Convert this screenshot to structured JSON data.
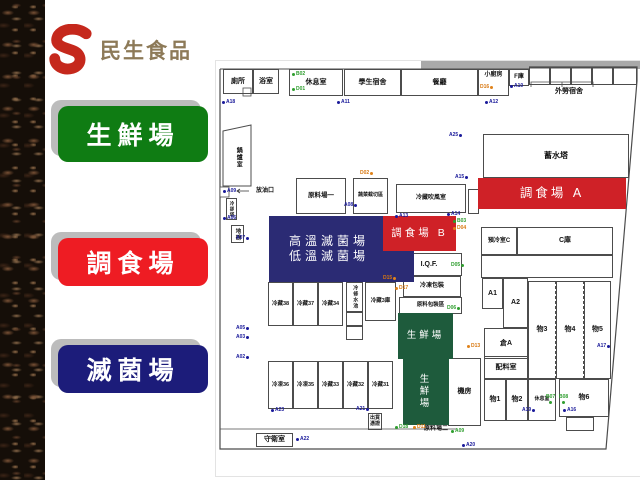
{
  "logo": {
    "brand": "民生食品",
    "accent_color": "#c5281c",
    "text_color": "#8d7a58"
  },
  "legend": [
    {
      "id": "fresh-area",
      "label": "生鮮場",
      "color": "#0f7c13",
      "y": 106,
      "h": 56
    },
    {
      "id": "prepared-food-area",
      "label": "調食場",
      "color": "#ee1c23",
      "y": 238,
      "h": 48
    },
    {
      "id": "sterilization-area",
      "label": "滅菌場",
      "color": "#1c1c7a",
      "y": 345,
      "h": 48
    }
  ],
  "map": {
    "zones": [
      {
        "lines": [
          "高溫滅菌場",
          "低溫滅菌場"
        ],
        "color": "#2b2b74",
        "x": 53,
        "y": 155,
        "w": 145,
        "h": 66,
        "fs": 12,
        "alignL": true
      },
      {
        "lines": [
          "調食場 B"
        ],
        "color": "#cf2127",
        "x": 167,
        "y": 155,
        "w": 73,
        "h": 35,
        "fs": 10.5
      },
      {
        "lines": [
          "調食場 A"
        ],
        "color": "#cf2127",
        "x": 262,
        "y": 117,
        "w": 148,
        "h": 31,
        "fs": 12.5
      },
      {
        "lines": [
          "生鮮場"
        ],
        "color": "#1e5b3c",
        "x": 182,
        "y": 252,
        "w": 55,
        "h": 46,
        "fs": 9.5
      },
      {
        "lines": [
          "生",
          "鮮",
          "場"
        ],
        "color": "#1e5b3c",
        "x": 187,
        "y": 298,
        "w": 46,
        "h": 66,
        "fs": 9.5
      }
    ],
    "rooms": [
      {
        "t": "廁所",
        "x": 7,
        "y": 8,
        "w": 30,
        "h": 25,
        "fs": 7
      },
      {
        "t": "浴室",
        "x": 37,
        "y": 8,
        "w": 26,
        "h": 25,
        "fs": 7
      },
      {
        "t": "休息室",
        "x": 73,
        "y": 8,
        "w": 54,
        "h": 27,
        "fs": 7
      },
      {
        "t": "學生宿舍",
        "x": 128,
        "y": 8,
        "w": 57,
        "h": 27,
        "fs": 7
      },
      {
        "t": "餐廳",
        "x": 185,
        "y": 8,
        "w": 77,
        "h": 27,
        "fs": 7
      },
      {
        "t": "小廚房",
        "x": 262,
        "y": 8,
        "w": 31,
        "h": 27,
        "fs": 6,
        "top": true
      },
      {
        "t": "F庫",
        "x": 293,
        "y": 8,
        "w": 20,
        "h": 17,
        "fs": 6
      },
      {
        "t": "",
        "x": 313,
        "y": 6,
        "w": 21,
        "h": 18
      },
      {
        "t": "",
        "x": 334,
        "y": 6,
        "w": 21,
        "h": 18
      },
      {
        "t": "",
        "x": 355,
        "y": 6,
        "w": 21,
        "h": 18
      },
      {
        "t": "",
        "x": 376,
        "y": 6,
        "w": 21,
        "h": 18
      },
      {
        "t": "",
        "x": 397,
        "y": 6,
        "w": 24,
        "h": 18
      },
      {
        "t": "外勞宿舍",
        "x": 323,
        "y": 25,
        "w": 60,
        "h": 11,
        "fs": 7,
        "plain": true
      },
      {
        "t": "蓄水塔",
        "x": 267,
        "y": 73,
        "w": 146,
        "h": 44,
        "fs": 8
      },
      {
        "t": "預冷室C",
        "x": 265,
        "y": 166,
        "w": 36,
        "h": 28,
        "fs": 6
      },
      {
        "t": "C庫",
        "x": 301,
        "y": 166,
        "w": 96,
        "h": 28,
        "fs": 7
      },
      {
        "t": "",
        "x": 265,
        "y": 194,
        "w": 132,
        "h": 23
      },
      {
        "t": "A1",
        "x": 266,
        "y": 217,
        "w": 21,
        "h": 31,
        "fs": 7
      },
      {
        "t": "A2",
        "x": 287,
        "y": 217,
        "w": 25,
        "h": 50,
        "fs": 7
      },
      {
        "t": "倉A",
        "x": 268,
        "y": 267,
        "w": 44,
        "h": 31,
        "fs": 7
      },
      {
        "t": "物3",
        "x": 312,
        "y": 220,
        "w": 28,
        "h": 98,
        "fs": 7,
        "dashR": true
      },
      {
        "t": "物4",
        "x": 340,
        "y": 220,
        "w": 28,
        "h": 98,
        "fs": 7,
        "dashR": true
      },
      {
        "t": "物5",
        "x": 368,
        "y": 220,
        "w": 27,
        "h": 98,
        "fs": 7
      },
      {
        "t": "配料室",
        "x": 268,
        "y": 295,
        "w": 44,
        "h": 23,
        "fs": 7
      },
      {
        "t": "物1",
        "x": 268,
        "y": 318,
        "w": 22,
        "h": 42,
        "fs": 7
      },
      {
        "t": "物2",
        "x": 290,
        "y": 318,
        "w": 22,
        "h": 42,
        "fs": 7
      },
      {
        "t": "休息室",
        "x": 312,
        "y": 318,
        "w": 28,
        "h": 42,
        "fs": 5
      },
      {
        "t": "物6",
        "x": 343,
        "y": 318,
        "w": 50,
        "h": 38,
        "fs": 7
      },
      {
        "t": "",
        "x": 350,
        "y": 356,
        "w": 28,
        "h": 14
      },
      {
        "t": "機房",
        "x": 232,
        "y": 297,
        "w": 33,
        "h": 68,
        "fs": 7
      },
      {
        "t": "原料場一",
        "x": 80,
        "y": 117,
        "w": 50,
        "h": 36,
        "fs": 6.5
      },
      {
        "t": "蔬菜截切區",
        "x": 137,
        "y": 117,
        "w": 35,
        "h": 36,
        "fs": 5
      },
      {
        "t": "冷藏吹風室",
        "x": 180,
        "y": 123,
        "w": 70,
        "h": 29,
        "fs": 6
      },
      {
        "t": "",
        "x": 252,
        "y": 128,
        "w": 11,
        "h": 25
      },
      {
        "t": "I.Q.F.",
        "x": 180,
        "y": 192,
        "w": 66,
        "h": 23,
        "fs": 7
      },
      {
        "t": "冷凍包裝",
        "x": 187,
        "y": 215,
        "w": 58,
        "h": 21,
        "fs": 6
      },
      {
        "t": "原料包裝區",
        "x": 183,
        "y": 236,
        "w": 63,
        "h": 17,
        "fs": 5.5
      },
      {
        "t": "冷藏38",
        "x": 52,
        "y": 221,
        "w": 25,
        "h": 44,
        "fs": 5.5
      },
      {
        "t": "冷藏37",
        "x": 77,
        "y": 221,
        "w": 25,
        "h": 44,
        "fs": 5.5
      },
      {
        "t": "冷藏34",
        "x": 102,
        "y": 221,
        "w": 25,
        "h": 44,
        "fs": 5.5
      },
      {
        "t": "冷修水池",
        "x": 130,
        "y": 221,
        "w": 17,
        "h": 30,
        "fs": 5,
        "v": true
      },
      {
        "t": "",
        "x": 130,
        "y": 251,
        "w": 17,
        "h": 14
      },
      {
        "t": "",
        "x": 130,
        "y": 265,
        "w": 17,
        "h": 14
      },
      {
        "t": "冷藏3庫",
        "x": 149,
        "y": 221,
        "w": 31,
        "h": 39,
        "fs": 5.5
      },
      {
        "t": "冷凍36",
        "x": 52,
        "y": 300,
        "w": 25,
        "h": 48,
        "fs": 5.5
      },
      {
        "t": "冷凍35",
        "x": 77,
        "y": 300,
        "w": 25,
        "h": 48,
        "fs": 5.5
      },
      {
        "t": "冷藏33",
        "x": 102,
        "y": 300,
        "w": 25,
        "h": 48,
        "fs": 5.5
      },
      {
        "t": "冷藏32",
        "x": 127,
        "y": 300,
        "w": 25,
        "h": 48,
        "fs": 5.5
      },
      {
        "t": "冷藏31",
        "x": 152,
        "y": 300,
        "w": 25,
        "h": 48,
        "fs": 5.5
      },
      {
        "t": "守衛室",
        "x": 40,
        "y": 372,
        "w": 37,
        "h": 14,
        "fs": 7
      },
      {
        "t": "出貨\n憑證",
        "x": 152,
        "y": 352,
        "w": 14,
        "h": 17,
        "fs": 5
      },
      {
        "t": "原料場二",
        "x": 200,
        "y": 363,
        "w": 40,
        "h": 10,
        "fs": 6,
        "plain": true
      },
      {
        "t": "鍋爐室",
        "x": 15,
        "y": 76,
        "w": 14,
        "h": 40,
        "fs": 6,
        "v": true,
        "plain": true
      },
      {
        "t": "冷卻塔",
        "x": 10,
        "y": 137,
        "w": 11,
        "h": 22,
        "fs": 4.5,
        "v": true
      },
      {
        "t": "地磅",
        "x": 15,
        "y": 164,
        "w": 13,
        "h": 18,
        "fs": 5.5,
        "v": true
      },
      {
        "t": "放油口",
        "x": 37,
        "y": 126,
        "w": 24,
        "h": 9,
        "fs": 6,
        "plain": true
      }
    ],
    "markers": [
      {
        "t": "A18",
        "c": "b",
        "x": 6,
        "y": 39,
        "s": "l"
      },
      {
        "t": "A11",
        "c": "b",
        "x": 121,
        "y": 39,
        "s": "l"
      },
      {
        "t": "A12",
        "c": "b",
        "x": 269,
        "y": 39,
        "s": "l"
      },
      {
        "t": "A10",
        "c": "b",
        "x": 294,
        "y": 23,
        "s": "l"
      },
      {
        "t": "B02",
        "c": "g",
        "x": 76,
        "y": 11,
        "s": "l"
      },
      {
        "t": "D01",
        "c": "g",
        "x": 76,
        "y": 26,
        "s": "l"
      },
      {
        "t": "D16",
        "c": "o",
        "x": 264,
        "y": 24,
        "s": "r"
      },
      {
        "t": "A25",
        "c": "b",
        "x": 233,
        "y": 72,
        "s": "r"
      },
      {
        "t": "A15",
        "c": "b",
        "x": 239,
        "y": 114,
        "s": "r"
      },
      {
        "t": "A13",
        "c": "b",
        "x": 179,
        "y": 153,
        "s": "l"
      },
      {
        "t": "A14",
        "c": "b",
        "x": 231,
        "y": 151,
        "s": "l"
      },
      {
        "t": "B03",
        "c": "g",
        "x": 237,
        "y": 158,
        "s": "l"
      },
      {
        "t": "D04",
        "c": "o",
        "x": 237,
        "y": 165,
        "s": "l"
      },
      {
        "t": "A07",
        "c": "b",
        "x": 20,
        "y": 175,
        "s": "r"
      },
      {
        "t": "A06",
        "c": "b",
        "x": 7,
        "y": 155,
        "s": "l"
      },
      {
        "t": "A09",
        "c": "b",
        "x": 7,
        "y": 128,
        "s": "l"
      },
      {
        "t": "A08",
        "c": "b",
        "x": 128,
        "y": 142,
        "s": "r"
      },
      {
        "t": "D02",
        "c": "o",
        "x": 144,
        "y": 110,
        "s": "r"
      },
      {
        "t": "A05",
        "c": "b",
        "x": 20,
        "y": 265,
        "s": "r"
      },
      {
        "t": "A03",
        "c": "b",
        "x": 20,
        "y": 274,
        "s": "r"
      },
      {
        "t": "A02",
        "c": "b",
        "x": 20,
        "y": 294,
        "s": "r"
      },
      {
        "t": "D15",
        "c": "o",
        "x": 167,
        "y": 215,
        "s": "r"
      },
      {
        "t": "D17",
        "c": "o",
        "x": 179,
        "y": 225,
        "s": "l"
      },
      {
        "t": "D05",
        "c": "g",
        "x": 235,
        "y": 202,
        "s": "r"
      },
      {
        "t": "D06",
        "c": "g",
        "x": 231,
        "y": 245,
        "s": "r"
      },
      {
        "t": "D13",
        "c": "o",
        "x": 251,
        "y": 283,
        "s": "l"
      },
      {
        "t": "A23",
        "c": "b",
        "x": 55,
        "y": 347,
        "s": "l"
      },
      {
        "t": "A21",
        "c": "b",
        "x": 140,
        "y": 346,
        "s": "r"
      },
      {
        "t": "A22",
        "c": "b",
        "x": 80,
        "y": 376,
        "s": "l"
      },
      {
        "t": "A20",
        "c": "b",
        "x": 246,
        "y": 382,
        "s": "l"
      },
      {
        "t": "A19",
        "c": "b",
        "x": 306,
        "y": 347,
        "s": "r"
      },
      {
        "t": "A16",
        "c": "b",
        "x": 347,
        "y": 347,
        "s": "l"
      },
      {
        "t": "A17",
        "c": "b",
        "x": 381,
        "y": 283,
        "s": "r"
      },
      {
        "t": "B07",
        "c": "g",
        "x": 330,
        "y": 334,
        "s": "a"
      },
      {
        "t": "B08",
        "c": "g",
        "x": 343,
        "y": 334,
        "s": "a"
      },
      {
        "t": "D18",
        "c": "g",
        "x": 179,
        "y": 364,
        "s": "l"
      },
      {
        "t": "D11",
        "c": "o",
        "x": 197,
        "y": 364,
        "s": "l"
      },
      {
        "t": "A09",
        "c": "g",
        "x": 235,
        "y": 368,
        "s": "l"
      }
    ]
  }
}
